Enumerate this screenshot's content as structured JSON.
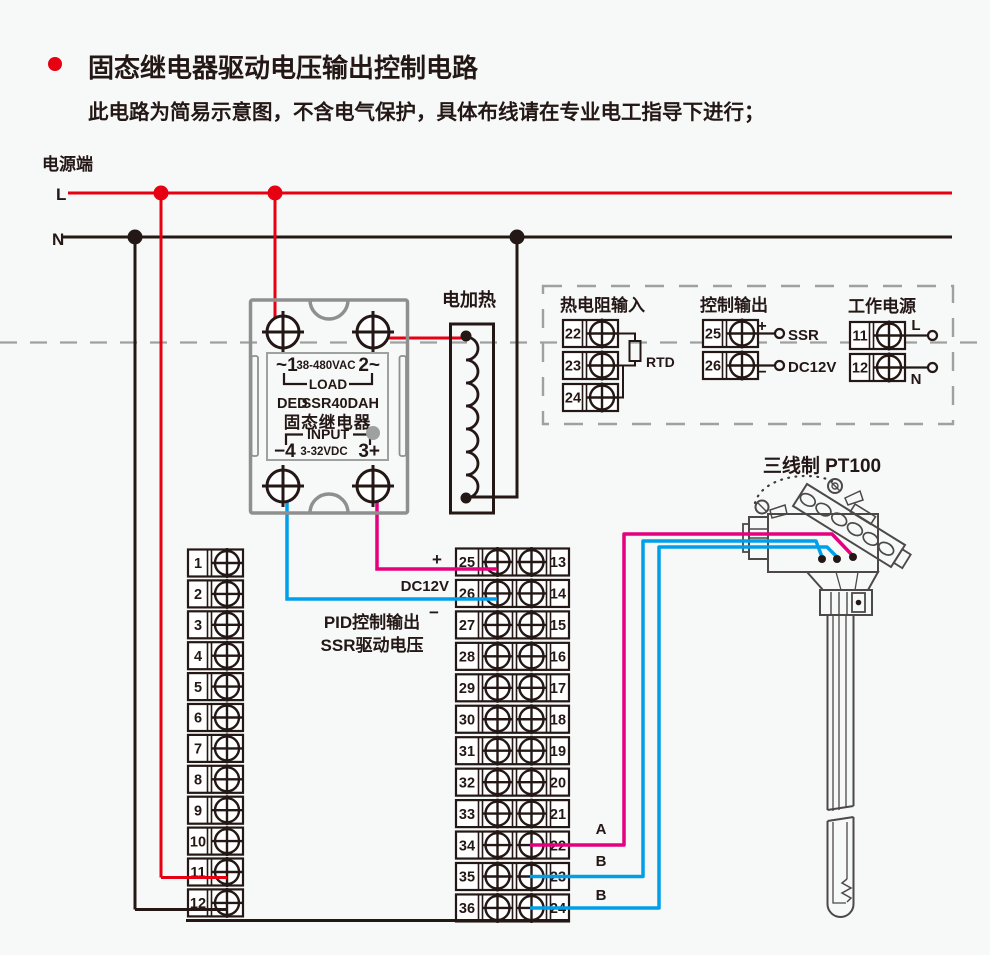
{
  "title": {
    "text": "固态继电器驱动电压输出控制电路",
    "subtitle": "此电路为简易示意图，不含电气保护，具体布线请在专业电工指导下进行；"
  },
  "power_rail": {
    "label": "电源端",
    "live": "L",
    "neutral": "N"
  },
  "ssr": {
    "terminal_1": "~1",
    "voltage_rating": "38-480VAC",
    "terminal_2": "2~",
    "load": "LOAD",
    "brand": "DED",
    "model": "SSR40DAH",
    "name": "固态继电器",
    "input": "INPUT",
    "terminal_4": "−4",
    "control_voltage": "3-32VDC",
    "terminal_3": "3+"
  },
  "heater": {
    "label": "电加热"
  },
  "panel": {
    "rtd_group": {
      "title": "热电阻输入",
      "terminals": [
        "22",
        "23",
        "24"
      ],
      "component": "RTD"
    },
    "output_group": {
      "title": "控制输出",
      "terminals": [
        "25",
        "26"
      ],
      "plus": "+",
      "minus": "−",
      "line1": "SSR",
      "line2": "DC12V"
    },
    "supply_group": {
      "title": "工作电源",
      "terminals": [
        "11",
        "12"
      ],
      "live": "L",
      "neutral": "N"
    }
  },
  "strip_left": {
    "numbers": [
      "1",
      "2",
      "3",
      "4",
      "5",
      "6",
      "7",
      "8",
      "9",
      "10",
      "11",
      "12"
    ]
  },
  "strip_center": {
    "left_numbers": [
      "25",
      "26",
      "27",
      "28",
      "29",
      "30",
      "31",
      "32",
      "33",
      "34",
      "35",
      "36"
    ],
    "right_numbers": [
      "13",
      "14",
      "15",
      "16",
      "17",
      "18",
      "19",
      "20",
      "21",
      "22",
      "23",
      "24"
    ]
  },
  "pid_output": {
    "plus": "+",
    "dc12v": "DC12V",
    "minus": "−",
    "line1": "PID控制输出",
    "line2": "SSR驱动电压"
  },
  "sensor": {
    "title": "三线制 PT100",
    "wire_a": "A",
    "wire_b1": "B",
    "wire_b2": "B"
  },
  "colors": {
    "live_wire": "#e60012",
    "neutral_wire": "#231815",
    "drive_positive_wire": "#e4007f",
    "drive_negative_wire": "#00a0e9",
    "model_text": "#e60012",
    "outline_gray": "#9fa0a0"
  }
}
